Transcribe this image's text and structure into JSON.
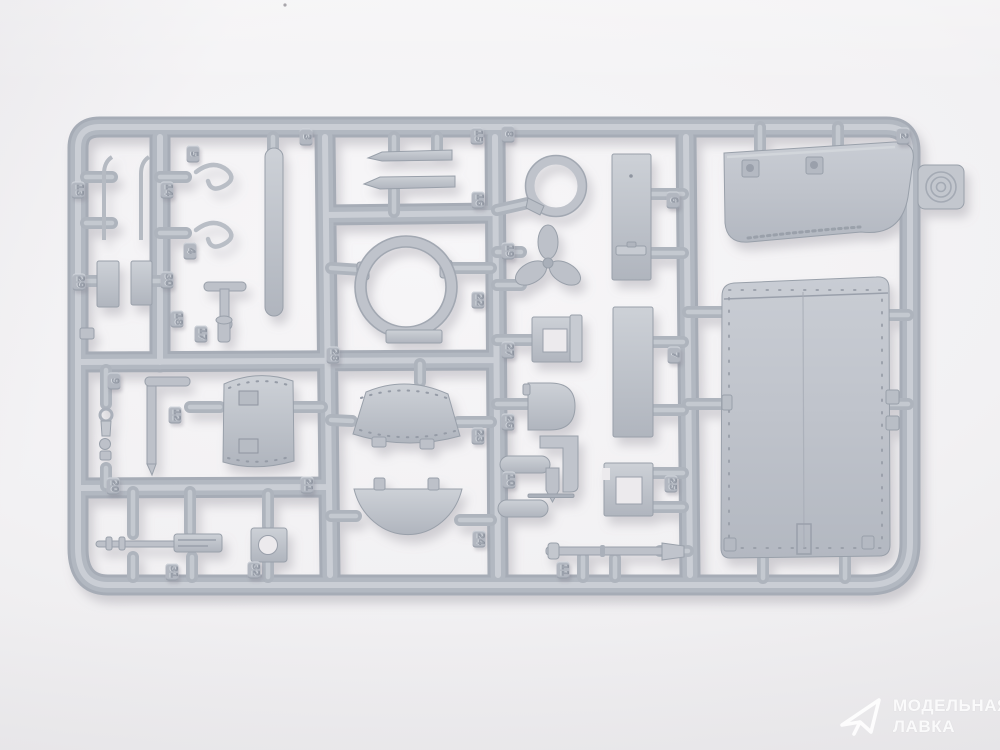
{
  "photo": {
    "subject": "gray injection-molded plastic model kit sprue (parts tree) photographed on a light backdrop",
    "plastic_color": "#b4b9c2",
    "plastic_highlight": "#cdd1d7",
    "plastic_shadow": "#9aa0ab",
    "background_color": "#f2f1f3"
  },
  "watermark": {
    "brand_line1": "МОДЕЛЬНАЯ",
    "brand_line2": "ЛАВКА",
    "icon": "paper-plane-logo",
    "text_color": "#ffffff"
  },
  "sprue": {
    "tabs": [
      {
        "label": "13",
        "x": 78,
        "y": 190
      },
      {
        "label": "14",
        "x": 167,
        "y": 190
      },
      {
        "label": "5",
        "x": 193,
        "y": 154
      },
      {
        "label": "4",
        "x": 190,
        "y": 251
      },
      {
        "label": "3",
        "x": 306,
        "y": 137
      },
      {
        "label": "29",
        "x": 79,
        "y": 282
      },
      {
        "label": "30",
        "x": 167,
        "y": 280
      },
      {
        "label": "18",
        "x": 177,
        "y": 319
      },
      {
        "label": "17",
        "x": 201,
        "y": 334
      },
      {
        "label": "9",
        "x": 114,
        "y": 381
      },
      {
        "label": "12",
        "x": 175,
        "y": 415
      },
      {
        "label": "20",
        "x": 113,
        "y": 486
      },
      {
        "label": "21",
        "x": 307,
        "y": 485
      },
      {
        "label": "31",
        "x": 172,
        "y": 572
      },
      {
        "label": "32",
        "x": 254,
        "y": 570
      },
      {
        "label": "15",
        "x": 477,
        "y": 136
      },
      {
        "label": "16",
        "x": 478,
        "y": 200
      },
      {
        "label": "22",
        "x": 478,
        "y": 300
      },
      {
        "label": "28",
        "x": 333,
        "y": 355
      },
      {
        "label": "23",
        "x": 478,
        "y": 436
      },
      {
        "label": "24",
        "x": 479,
        "y": 539
      },
      {
        "label": "8",
        "x": 508,
        "y": 134
      },
      {
        "label": "19",
        "x": 508,
        "y": 251
      },
      {
        "label": "27",
        "x": 508,
        "y": 350
      },
      {
        "label": "26",
        "x": 508,
        "y": 422
      },
      {
        "label": "10",
        "x": 509,
        "y": 480
      },
      {
        "label": "6",
        "x": 673,
        "y": 200
      },
      {
        "label": "7",
        "x": 674,
        "y": 355
      },
      {
        "label": "25",
        "x": 671,
        "y": 484
      },
      {
        "label": "11",
        "x": 563,
        "y": 570
      },
      {
        "label": "2",
        "x": 903,
        "y": 136
      }
    ]
  }
}
